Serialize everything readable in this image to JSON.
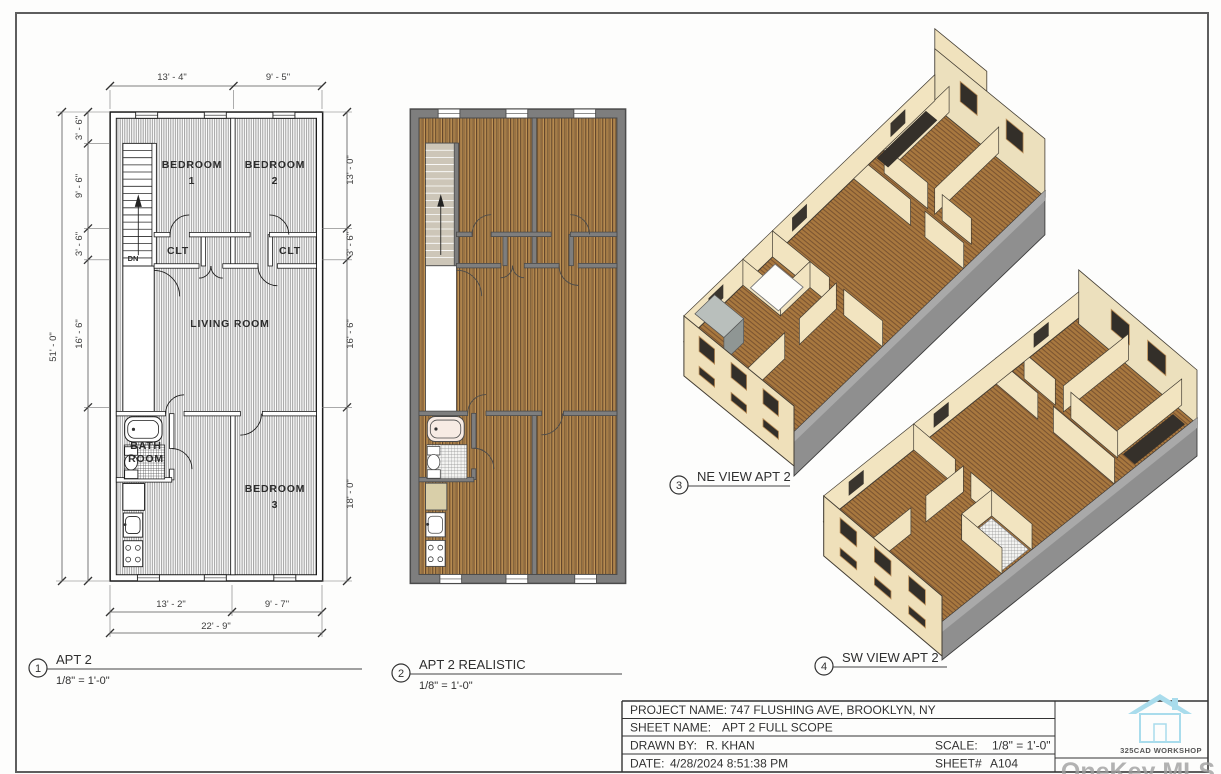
{
  "sheet": {
    "views": [
      {
        "num": "1",
        "title": "APT 2",
        "scale": "1/8\" = 1'-0\""
      },
      {
        "num": "2",
        "title": "APT 2 REALISTIC",
        "scale": "1/8\" = 1'-0\""
      },
      {
        "num": "3",
        "title": "NE VIEW APT 2"
      },
      {
        "num": "4",
        "title": "SW VIEW APT 2"
      }
    ],
    "plan1": {
      "rooms": {
        "bedroom1_l1": "BEDROOM",
        "bedroom1_l2": "1",
        "bedroom2_l1": "BEDROOM",
        "bedroom2_l2": "2",
        "closet1": "CLT",
        "closet2": "CLT",
        "living": "LIVING ROOM",
        "bath_l1": "BATH",
        "bath_l2": "ROOM",
        "bedroom3_l1": "BEDROOM",
        "bedroom3_l2": "3",
        "down": "DN"
      },
      "dims": {
        "top": [
          "13' - 4\"",
          "9' - 5\""
        ],
        "bottom": [
          "13' - 2\"",
          "9' - 7\"",
          "22' - 9\""
        ],
        "left": [
          "3' - 6\"",
          "9' - 6\"",
          "3' - 6\"",
          "16' - 6\"",
          "51' - 0\""
        ],
        "right": [
          "13' - 0\"",
          "3' - 6\"",
          "16' - 6\"",
          "18' - 0\""
        ]
      }
    },
    "titleblock": {
      "project_label": "PROJECT NAME:",
      "project": "747 FLUSHING AVE, BROOKLYN, NY",
      "sheet_label": "SHEET NAME:",
      "sheet": "APT 2 FULL SCOPE",
      "drawn_label": "DRAWN BY:",
      "drawn": "R. KHAN",
      "scale_label": "SCALE:",
      "scale": "1/8\" = 1'-0\"",
      "date_label": "DATE:",
      "date": "4/28/2024 8:51:38 PM",
      "sheetnum_label": "SHEET#",
      "sheetnum": "A104",
      "logo_text": "325CAD WORKSHOP"
    },
    "watermark": "OneKey MLS"
  }
}
